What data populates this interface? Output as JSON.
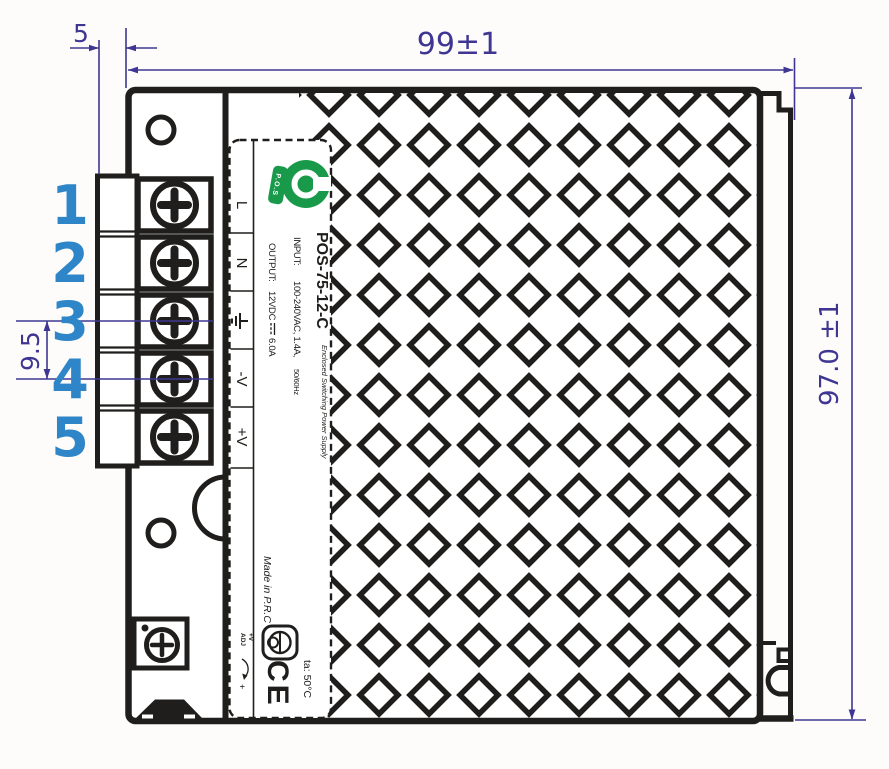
{
  "drawing": {
    "title": "power-supply-side-view-technical-drawing",
    "dimensions": {
      "top_offset": "5",
      "width": "99±1",
      "height": "97.0 ±1",
      "terminal_pitch": "9.5"
    },
    "terminal_numbers": [
      "1",
      "2",
      "3",
      "4",
      "5"
    ],
    "terminals": {
      "line": "L",
      "neutral": "N",
      "ground_icon": "earth-ground-icon",
      "negative": "-V",
      "positive": "+V"
    },
    "label": {
      "logo_text": "P.O.S",
      "model": "POS-75-12-C",
      "subtitle": "Enclosed Switching Power Supply",
      "input_label": "INPUT:",
      "input_value": "100-240VAC, 1.4A,",
      "input_freq": "50/60Hz",
      "output_label": "OUTPUT:",
      "output_voltage": "12VDC",
      "dc_icon": "direct-current-icon",
      "output_current": "6.0A",
      "made_in": "Made in P.R.C",
      "adj_top": "+V",
      "adj_bottom": "ADJ",
      "adj_plus": "+",
      "ce_mark": "CE",
      "temp": "ta: 50°C"
    },
    "colors": {
      "line": "#1f1e1c",
      "dim": "#3e3692",
      "num": "#2e86c8",
      "green": "#189a4a"
    }
  }
}
